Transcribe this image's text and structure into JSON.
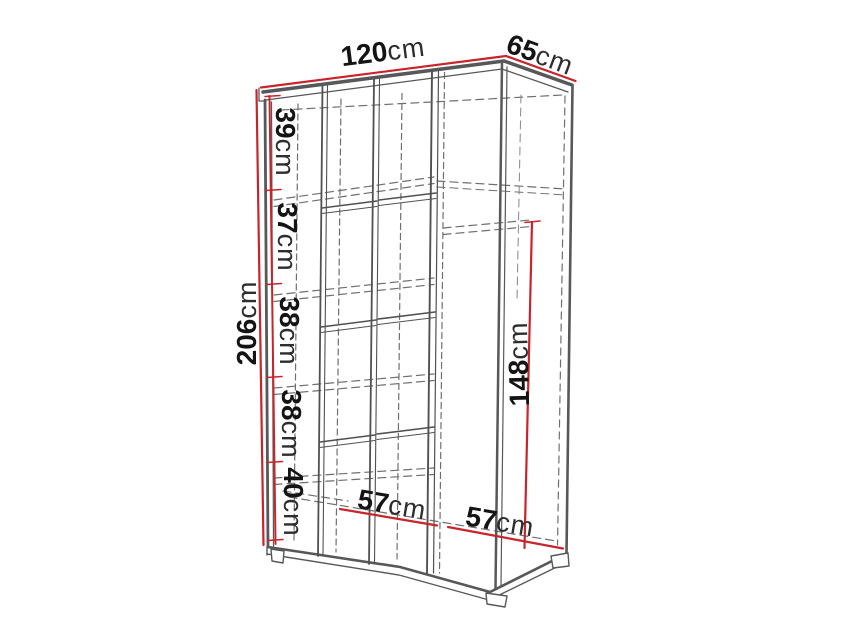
{
  "diagram": {
    "subject": "wardrobe-dimension-drawing",
    "unit": "cm",
    "colors": {
      "dimension_line": "#c9242a",
      "drawing_line": "#57585a",
      "hidden_line": "#6e6f71",
      "text": "#141414",
      "background": "#ffffff"
    },
    "dimensions": {
      "width": {
        "value": "120",
        "unit": "cm"
      },
      "depth": {
        "value": "65",
        "unit": "cm"
      },
      "height": {
        "value": "206",
        "unit": "cm"
      },
      "hanging_section_height": {
        "value": "148",
        "unit": "cm"
      },
      "left_section_width": {
        "value": "57",
        "unit": "cm"
      },
      "right_section_width": {
        "value": "57",
        "unit": "cm"
      },
      "shelf_gaps": [
        {
          "value": "39",
          "unit": "cm"
        },
        {
          "value": "37",
          "unit": "cm"
        },
        {
          "value": "38",
          "unit": "cm"
        },
        {
          "value": "38",
          "unit": "cm"
        },
        {
          "value": "40",
          "unit": "cm"
        }
      ]
    }
  }
}
